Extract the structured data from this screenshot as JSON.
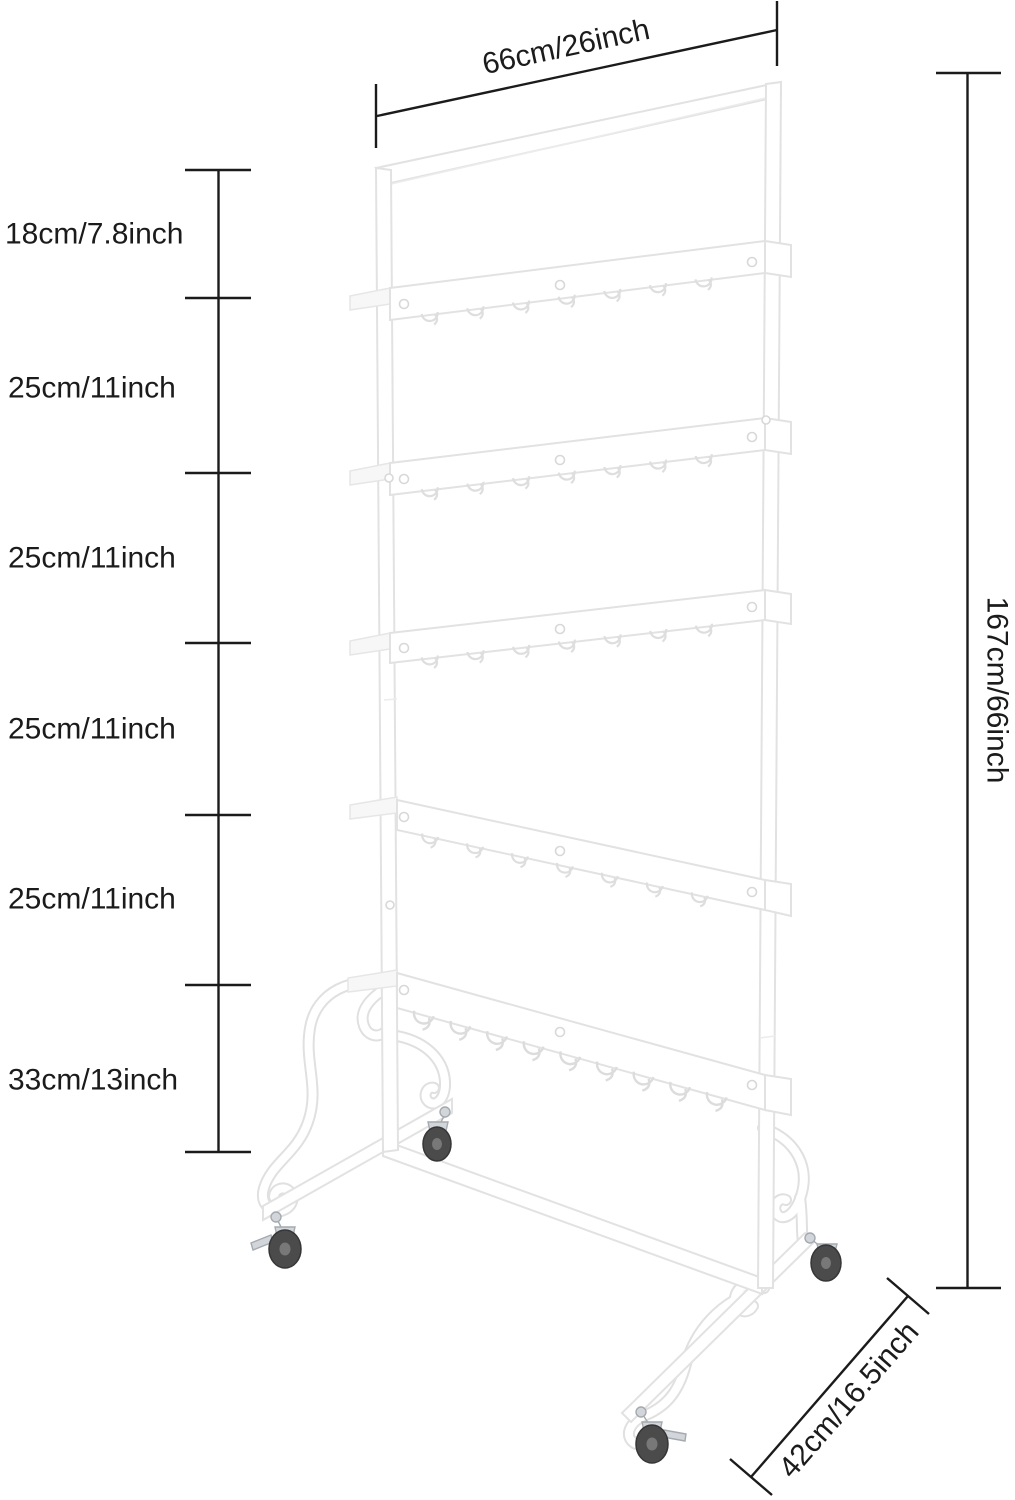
{
  "title": "Rolling hook display rack — dimension diagram",
  "product": {
    "type": "rolling display rack with hook shelves",
    "shelf_count": 5,
    "caster_count": 4
  },
  "dimensions": {
    "top_width": "66cm/26inch",
    "right_height": "167cm/66inch",
    "bottom_depth": "42cm/16.5inch",
    "left_segments": [
      "18cm/7.8inch",
      "25cm/11inch",
      "25cm/11inch",
      "25cm/11inch",
      "25cm/11inch",
      "33cm/13inch"
    ]
  },
  "colors": {
    "annotation": "#1b1b1b",
    "rack_outline": "#e2e2e2",
    "rack_fill": "#ffffff",
    "wheel": "#4b4b4b",
    "caster_metal": "#d2d6da",
    "background": "#ffffff"
  }
}
